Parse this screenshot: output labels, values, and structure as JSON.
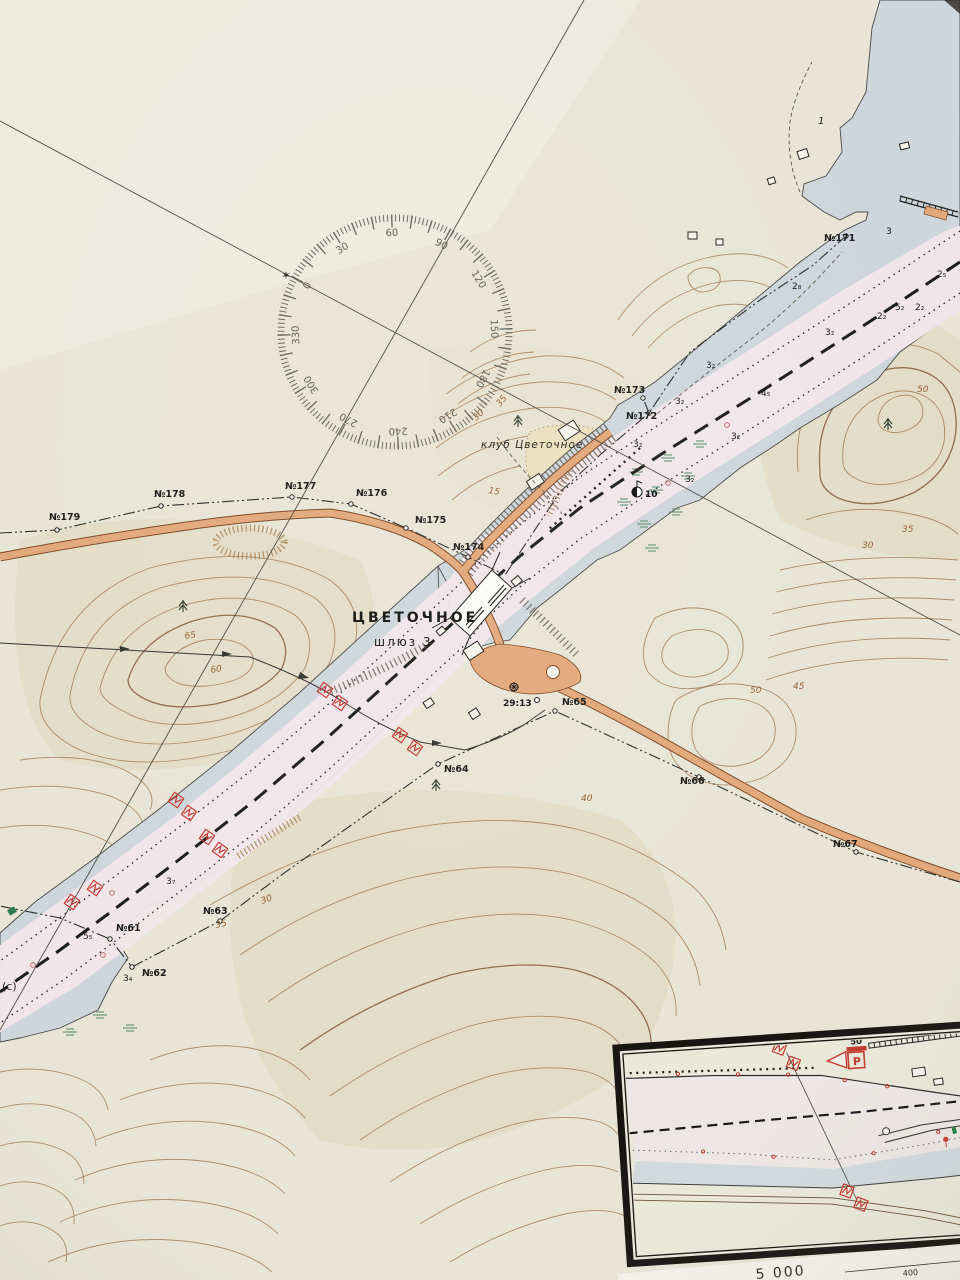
{
  "map": {
    "place_title": "ЦВЕТОЧНОЕ",
    "place_subtitle": "шлюз 3",
    "club_label": "клуб Цветочное",
    "benchmark_label": "29:13",
    "area_note": "(с)",
    "spot_height_label": "1",
    "beacon_label": "10",
    "star_symbol": "✶"
  },
  "compass": {
    "labels": [
      {
        "t": "0",
        "x": 310,
        "y": 287,
        "rot": -62
      },
      {
        "t": "30",
        "x": 344,
        "y": 251,
        "rot": -32
      },
      {
        "t": "60",
        "x": 392,
        "y": 236,
        "rot": -2
      },
      {
        "t": "90",
        "x": 440,
        "y": 247,
        "rot": 28
      },
      {
        "t": "120",
        "x": 476,
        "y": 281,
        "rot": 58
      },
      {
        "t": "150",
        "x": 491,
        "y": 329,
        "rot": 88
      },
      {
        "t": "180",
        "x": 480,
        "y": 377,
        "rot": 118
      },
      {
        "t": "210",
        "x": 446,
        "y": 413,
        "rot": 148
      },
      {
        "t": "240",
        "x": 398,
        "y": 428,
        "rot": 178
      },
      {
        "t": "270",
        "x": 350,
        "y": 417,
        "rot": 208
      },
      {
        "t": "300",
        "x": 314,
        "y": 383,
        "rot": 238
      },
      {
        "t": "330",
        "x": 299,
        "y": 335,
        "rot": 268
      }
    ]
  },
  "shore_markers_north": [
    {
      "t": "№171",
      "x": 824,
      "y": 241,
      "cx": 846,
      "cy": 236
    },
    {
      "t": "№172",
      "x": 626,
      "y": 419,
      "cx": 649,
      "cy": 413
    },
    {
      "t": "№173",
      "x": 614,
      "y": 393,
      "cx": 643,
      "cy": 398
    },
    {
      "t": "№174",
      "x": 453,
      "y": 550,
      "cx": 468,
      "cy": 557
    },
    {
      "t": "№175",
      "x": 415,
      "y": 523,
      "cx": 406,
      "cy": 528
    },
    {
      "t": "№176",
      "x": 356,
      "y": 496,
      "cx": 351,
      "cy": 504
    },
    {
      "t": "№177",
      "x": 285,
      "y": 489,
      "cx": 292,
      "cy": 497
    },
    {
      "t": "№178",
      "x": 154,
      "y": 497,
      "cx": 161,
      "cy": 506
    },
    {
      "t": "№179",
      "x": 49,
      "y": 520,
      "cx": 57,
      "cy": 530
    }
  ],
  "shore_markers_south": [
    {
      "t": "№61",
      "x": 116,
      "y": 931,
      "cx": 110,
      "cy": 939
    },
    {
      "t": "№62",
      "x": 142,
      "y": 976,
      "cx": 132,
      "cy": 967
    },
    {
      "t": "№63",
      "x": 203,
      "y": 914,
      "cx": 220,
      "cy": 921
    },
    {
      "t": "№64",
      "x": 444,
      "y": 772,
      "cx": 438,
      "cy": 764
    },
    {
      "t": "№65",
      "x": 562,
      "y": 705,
      "cx": 555,
      "cy": 711
    },
    {
      "t": "№66",
      "x": 680,
      "y": 784,
      "cx": 699,
      "cy": 777
    },
    {
      "t": "№67",
      "x": 833,
      "y": 847,
      "cx": 856,
      "cy": 852
    }
  ],
  "depth_soundings": [
    {
      "t": "3₂",
      "x": 675,
      "y": 404
    },
    {
      "t": "3₂",
      "x": 731,
      "y": 439
    },
    {
      "t": "4₅",
      "x": 761,
      "y": 396
    },
    {
      "t": "3₂",
      "x": 706,
      "y": 368
    },
    {
      "t": "3₂",
      "x": 633,
      "y": 447
    },
    {
      "t": "3₂",
      "x": 685,
      "y": 482
    },
    {
      "t": "3",
      "x": 886,
      "y": 234
    },
    {
      "t": "2₅",
      "x": 937,
      "y": 277
    },
    {
      "t": "2₈",
      "x": 792,
      "y": 289
    },
    {
      "t": "5₂",
      "x": 895,
      "y": 310
    },
    {
      "t": "2₂",
      "x": 915,
      "y": 310
    },
    {
      "t": "2₂",
      "x": 877,
      "y": 319
    },
    {
      "t": "3₂",
      "x": 825,
      "y": 335
    },
    {
      "t": "5₅",
      "x": 83,
      "y": 939
    },
    {
      "t": "3₄",
      "x": 123,
      "y": 981
    },
    {
      "t": "3₇",
      "x": 166,
      "y": 884
    }
  ],
  "contour_labels": [
    {
      "t": "65",
      "x": 185,
      "y": 639,
      "rot": -8
    },
    {
      "t": "60",
      "x": 211,
      "y": 673,
      "rot": -10
    },
    {
      "t": "40",
      "x": 581,
      "y": 801
    },
    {
      "t": "35",
      "x": 216,
      "y": 928,
      "rot": -12
    },
    {
      "t": "30",
      "x": 262,
      "y": 904,
      "rot": -20
    },
    {
      "t": "15",
      "x": 488,
      "y": 493,
      "rot": 10
    },
    {
      "t": "30",
      "x": 476,
      "y": 421,
      "rot": -42
    },
    {
      "t": "35",
      "x": 500,
      "y": 407,
      "rot": -50
    },
    {
      "t": "50",
      "x": 917,
      "y": 392
    },
    {
      "t": "35",
      "x": 902,
      "y": 532
    },
    {
      "t": "30",
      "x": 862,
      "y": 548
    },
    {
      "t": "45",
      "x": 793,
      "y": 689
    },
    {
      "t": "50",
      "x": 750,
      "y": 693
    }
  ],
  "inset": {
    "parking_sign": "P",
    "distance_sign": "50",
    "scale_value": "5 000",
    "scale_distance": "400"
  }
}
